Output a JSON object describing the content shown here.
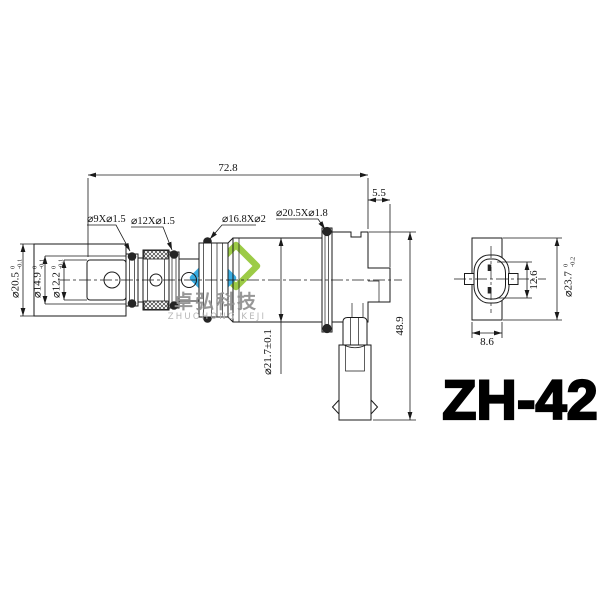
{
  "part_number": "ZH-42",
  "watermark": {
    "cn": "卓弘科技",
    "en": "ZHUOHONG KEJI"
  },
  "colors": {
    "line": "#1a1a1a",
    "logo_green": "#97c93d",
    "logo_blue": "#2fa8e0",
    "watermark_cn_text": "#8f8f8f",
    "watermark_en_text": "#b3b3b3",
    "part_text": "#000000"
  },
  "dimensions": {
    "total_length": "72.8",
    "step_length": "5.5",
    "total_height": "48.9",
    "coil_diameter": "⌀21.7±0.1",
    "connector_pin_span": "12.6",
    "connector_width": "8.6",
    "body_od": {
      "main": "⌀20.5",
      "sup": "0",
      "sub": "-0.1"
    },
    "bore_mid": {
      "main": "⌀14.9",
      "sup": "0",
      "sub": "-0.1"
    },
    "bore_small": {
      "main": "⌀12.2",
      "sup": "0",
      "sub": "-0.1"
    },
    "end_od": {
      "main": "⌀23.7",
      "sup": "0",
      "sub": "-0.2"
    }
  },
  "oring_labels": {
    "oring1": "⌀9X⌀1.5",
    "oring2": "⌀12X⌀1.5",
    "oring3": "⌀16.8X⌀2",
    "oring4": "⌀20.5X⌀1.8"
  }
}
